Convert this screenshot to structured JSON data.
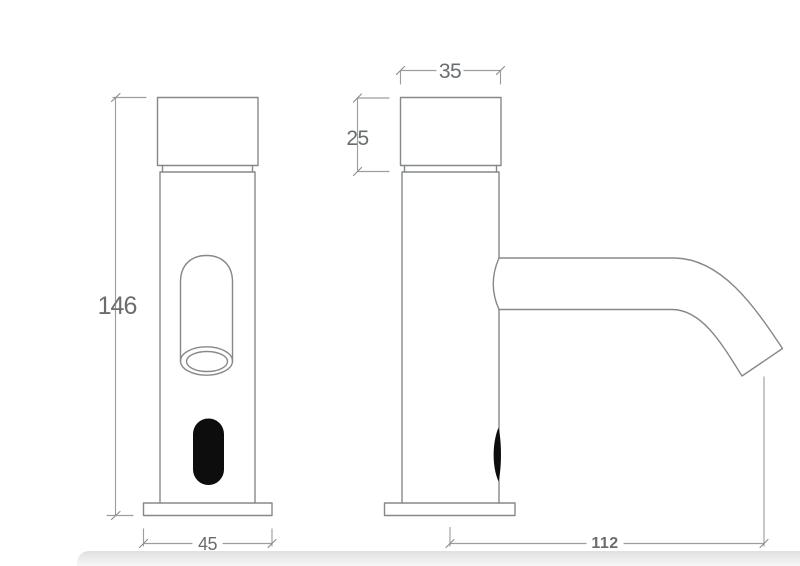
{
  "dimensions": {
    "front_height": "146",
    "front_base_width": "45",
    "side_top_width": "35",
    "side_top_height": "25",
    "side_base_reach": "112"
  },
  "colors": {
    "background": "#ffffff",
    "object_line": "#85888b",
    "dimension_line": "#9b9ea1",
    "dimension_text": "#6a6d70",
    "sensor_fill": "#0d0d0d",
    "footer_band": "#e0e0e0"
  }
}
